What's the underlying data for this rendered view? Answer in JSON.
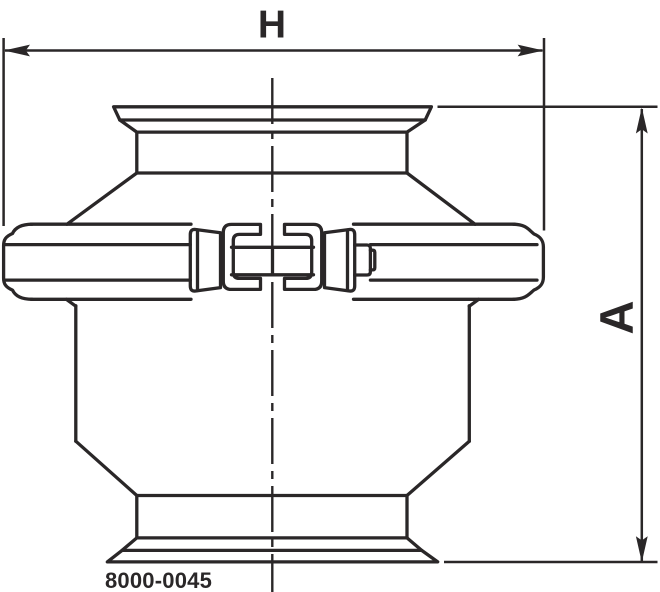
{
  "drawing": {
    "part_number": "8000-0045",
    "line_color": "#2a2728",
    "background_color": "#ffffff",
    "dimension_h": {
      "label": "H",
      "orientation": "horizontal"
    },
    "dimension_a": {
      "label": "A",
      "orientation": "vertical"
    }
  }
}
